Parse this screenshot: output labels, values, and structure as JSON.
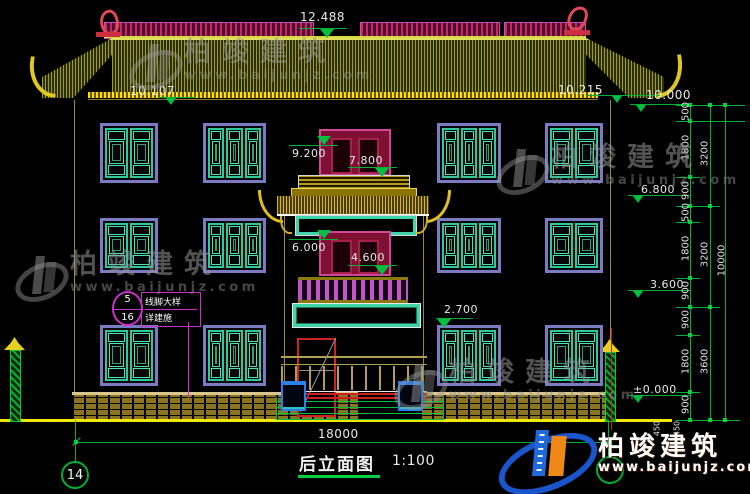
{
  "title": {
    "name": "后立面图",
    "scale": "1:100"
  },
  "grid": {
    "left_bubble": "14"
  },
  "callout": {
    "num": "5",
    "sheet": "16",
    "line1": "线脚大样",
    "line2": "详建施"
  },
  "brand": {
    "cn": "柏竣建筑",
    "url": "www.baijunjz.com"
  },
  "dims": {
    "overall_width": "18000",
    "ridge": "12.488",
    "eave_left": "10.107",
    "eave_right": "10.215",
    "eave_right2": "10.000",
    "tower": [
      "9.200",
      "7.800",
      "6.000",
      "4.600",
      "2.700"
    ],
    "elevs": [
      "10.000",
      "6.800",
      "3.600",
      "±0.000"
    ],
    "chain_inner": [
      "500",
      "1800",
      "900",
      "500",
      "1800",
      "900",
      "900",
      "1800",
      "900"
    ],
    "chain_mid": [
      "3200",
      "3200",
      "3600"
    ],
    "chain_outer": "10000",
    "chain_foot": [
      "450",
      "450"
    ]
  }
}
